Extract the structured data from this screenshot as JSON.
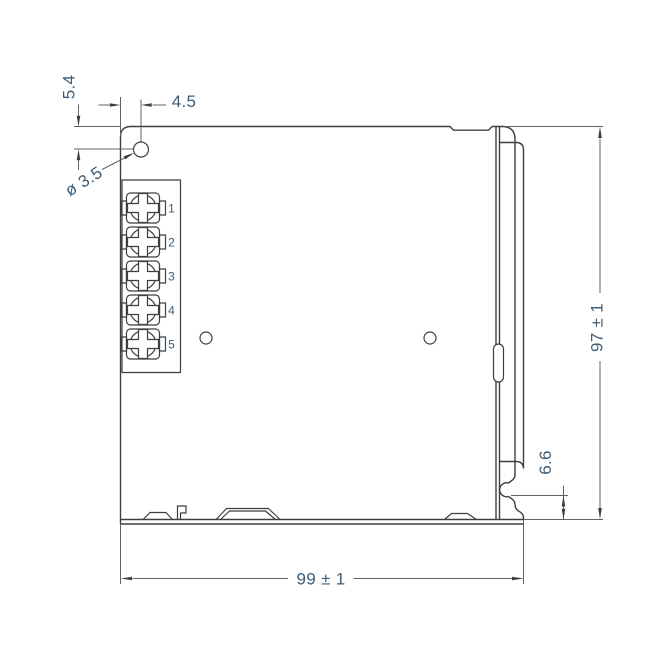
{
  "drawing": {
    "dimensions": {
      "top_edge_to_hole_center": "5.4",
      "left_edge_to_hole_center": "4.5",
      "hole_diameter": "ø 3.5",
      "body_height": "97 ± 1",
      "notch_to_bottom": "6.6",
      "body_width": "99 ± 1"
    },
    "terminal_labels": [
      "1",
      "2",
      "3",
      "4",
      "5"
    ]
  },
  "colors": {
    "outline": "#3e3e3e",
    "dimension_line": "#636363",
    "dimension_text": "#3c5c77",
    "background": "#ffffff"
  }
}
